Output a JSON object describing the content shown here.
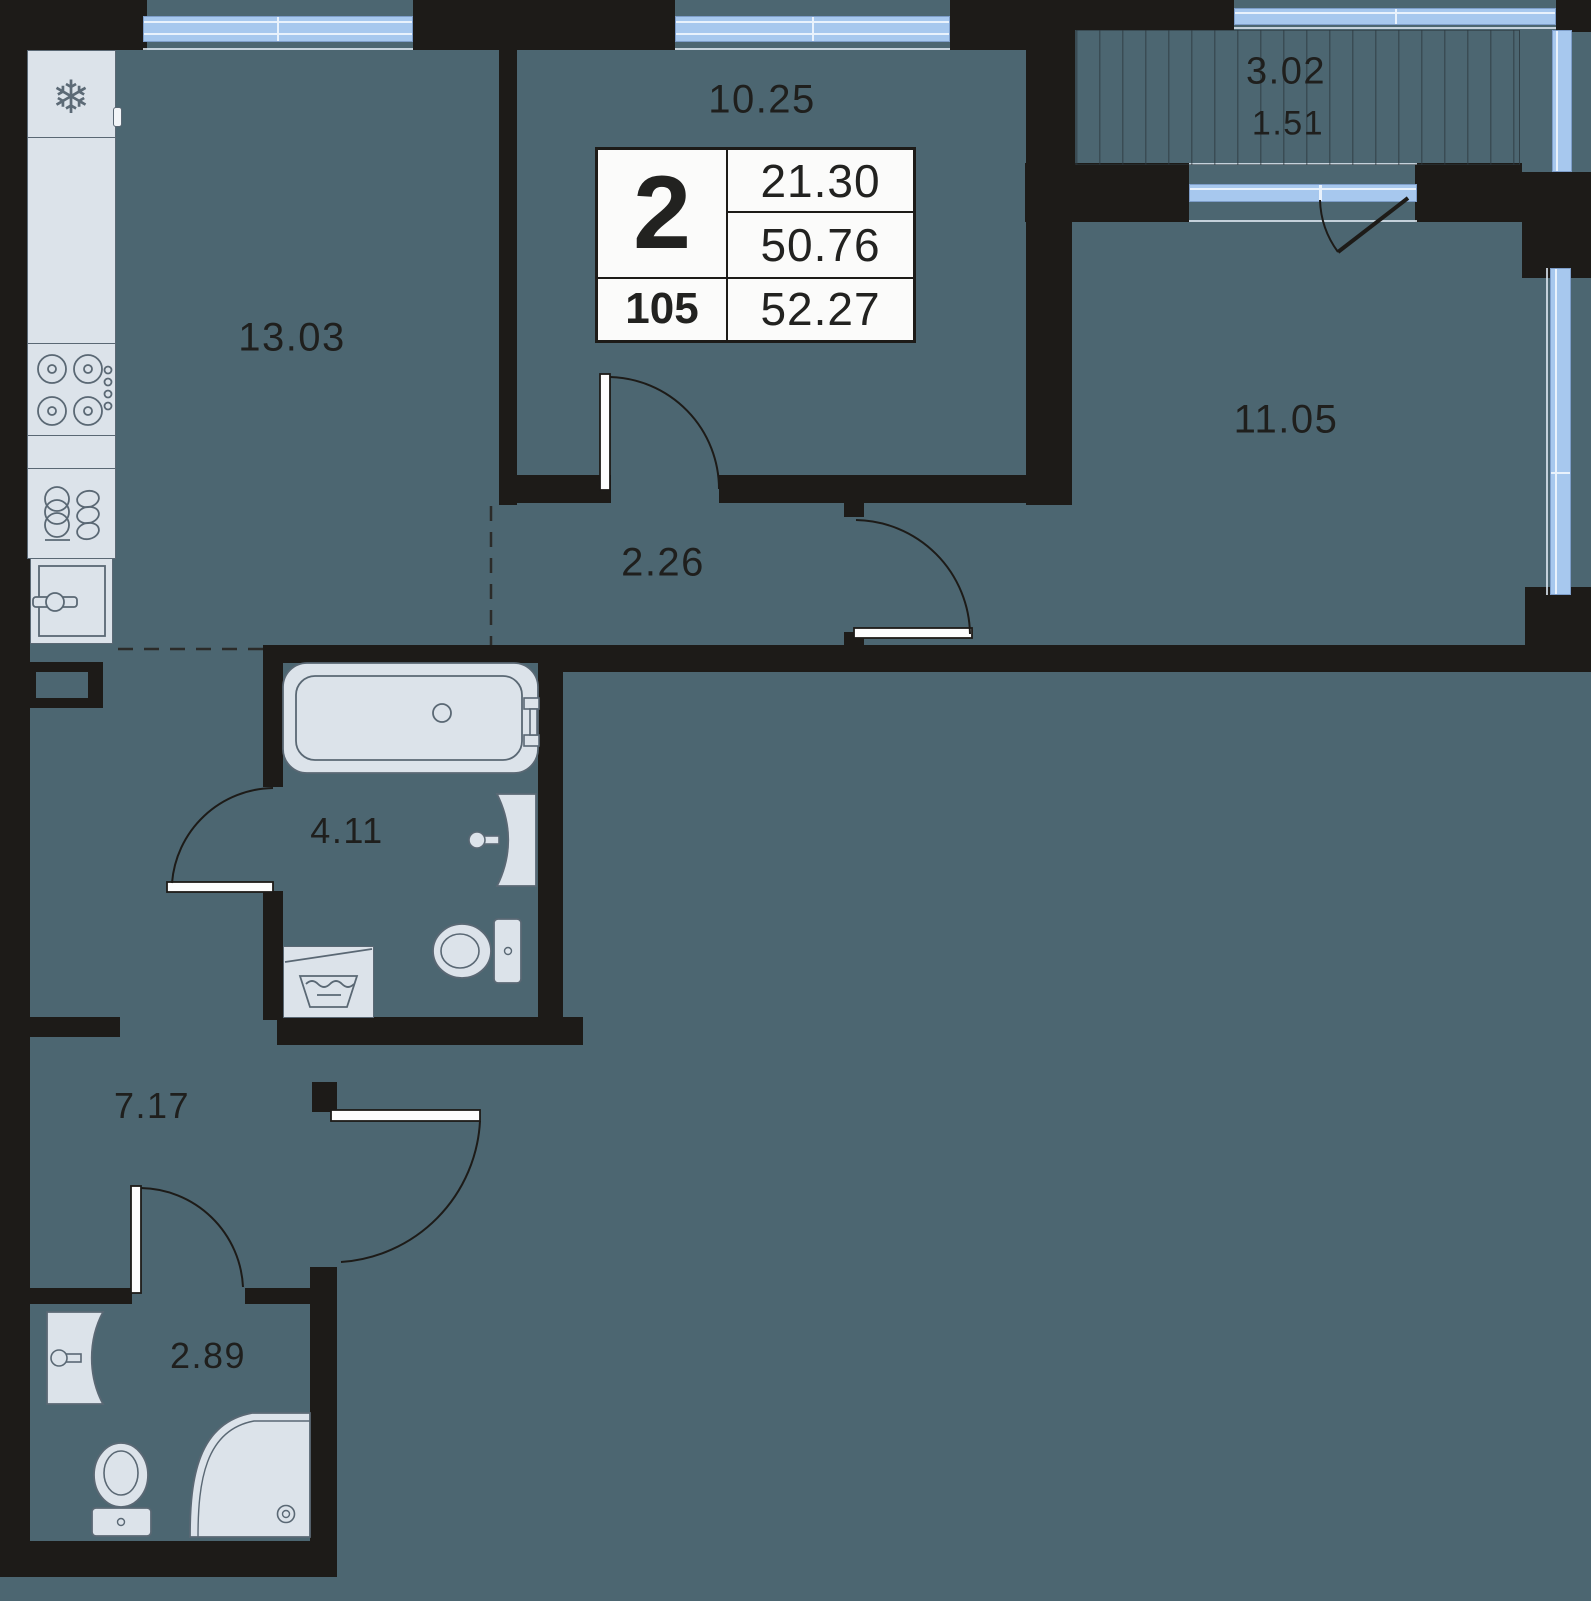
{
  "card": {
    "rooms": "2",
    "unit": "105",
    "living_area": "21.30",
    "area_without_balcony": "50.76",
    "total_area": "52.27"
  },
  "rooms": {
    "kitchen": "13.03",
    "room_top": "10.25",
    "room_right": "11.05",
    "corridor": "2.26",
    "bathroom": "4.11",
    "hall": "7.17",
    "wc": "2.89",
    "balcony_area": "3.02",
    "balcony_reduced": "1.51"
  },
  "icons": {
    "snowflake_glyph": "❄"
  },
  "colors": {
    "background": "#4C6671",
    "wall": "#1D1B18",
    "window": "#A7C8EE",
    "fixture_fill": "#DCE3EA",
    "fixture_stroke": "#5A6874",
    "card_bg": "#FBFBFA",
    "text": "#1F1F1D"
  }
}
